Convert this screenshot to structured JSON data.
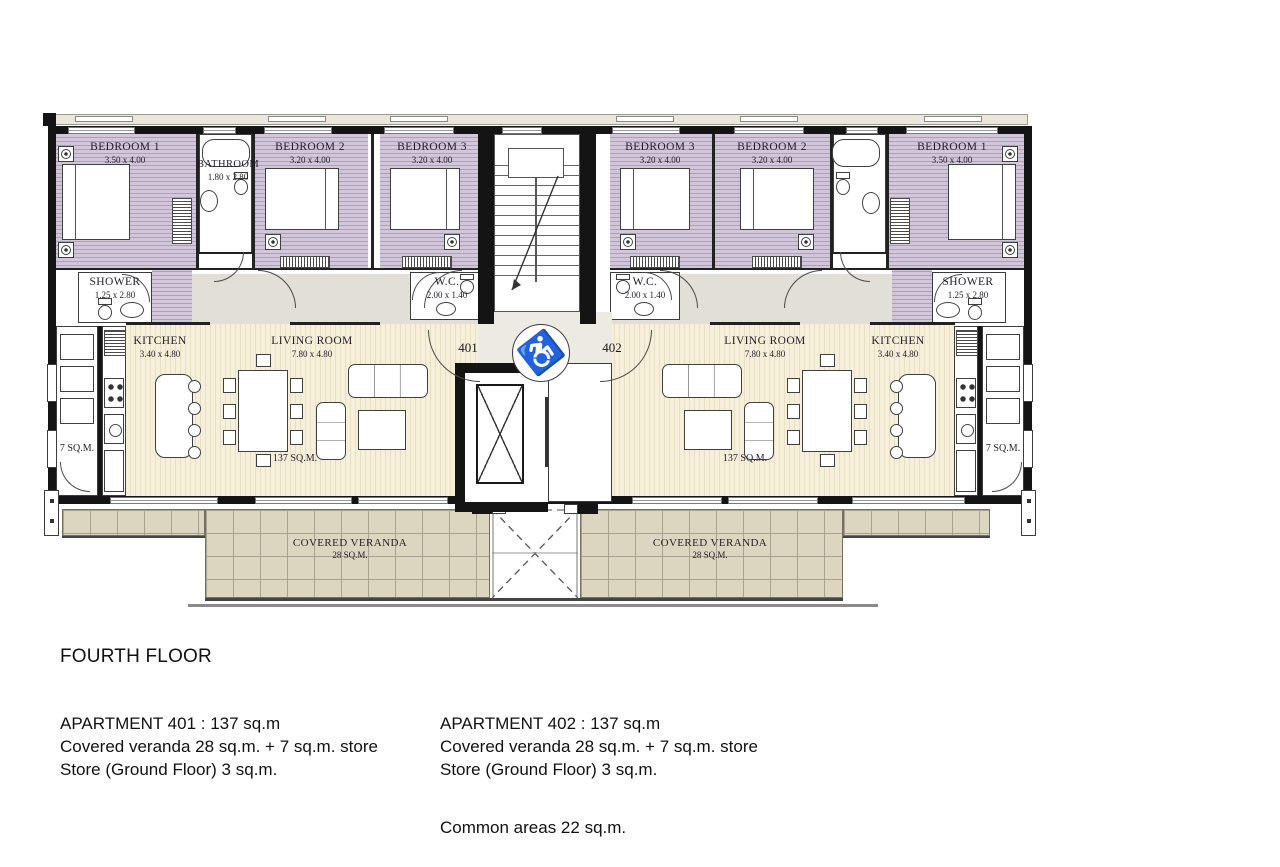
{
  "plan": {
    "rooms": {
      "bedroom1": {
        "name": "BEDROOM 1",
        "dim": "3.50 x 4.00"
      },
      "bedroom2": {
        "name": "BEDROOM 2",
        "dim": "3.20 x 4.00"
      },
      "bedroom3": {
        "name": "BEDROOM 3",
        "dim": "3.20 x 4.00"
      },
      "bathroom": {
        "name": "BATHROOM",
        "dim": "1.80 x 2.80"
      },
      "shower": {
        "name": "SHOWER",
        "dim": "1.25 x 2.80"
      },
      "wc": {
        "name": "W.C.",
        "dim": "2.00 x 1.40"
      },
      "kitchen": {
        "name": "KITCHEN",
        "dim": "3.40 x 4.80"
      },
      "living_room": {
        "name": "LIVING ROOM",
        "dim": "7.80 x 4.80"
      },
      "store_area": "7 SQ.M.",
      "apartment_area": "137 SQ.M.",
      "veranda": {
        "name": "COVERED VERANDA",
        "area": "28 SQ.M."
      }
    },
    "units": {
      "left_no": "401",
      "right_no": "402"
    },
    "icons": {
      "accessible": "♿"
    }
  },
  "legend": {
    "floor_title": "FOURTH FLOOR",
    "apartments": [
      {
        "lines": [
          "APARTMENT 401 : 137 sq.m",
          "Covered veranda 28 sq.m. + 7 sq.m. store",
          "Store (Ground Floor) 3 sq.m."
        ]
      },
      {
        "lines": [
          "APARTMENT 402 : 137 sq.m",
          "Covered veranda 28 sq.m. + 7 sq.m. store",
          "Store (Ground Floor) 3 sq.m."
        ],
        "extra": "Common areas 22 sq.m."
      }
    ]
  },
  "colors": {
    "bedroom_fill": "#d2c6db",
    "bedroom_stripe": "#ad9ebc",
    "living_fill": "#f6f0da",
    "living_stripe": "#e8e0c5",
    "veranda_fill": "#dcd6c1",
    "veranda_grid": "#a8a290",
    "wall": "#141414",
    "hall_fill": "#e1dfd7"
  }
}
